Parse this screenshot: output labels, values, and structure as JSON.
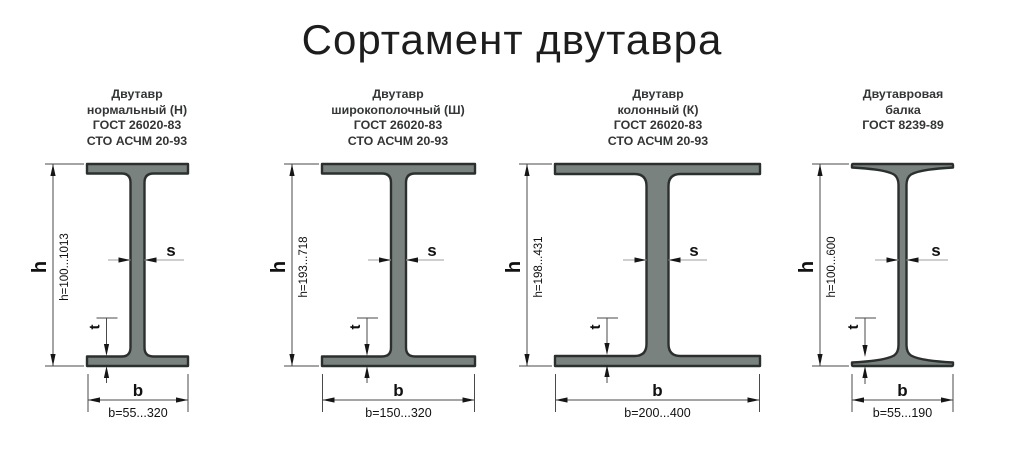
{
  "title": "Сортамент двутавра",
  "labels": {
    "h": "h",
    "s": "s",
    "t": "t",
    "b": "b"
  },
  "beams": [
    {
      "lines": [
        "Двутавр",
        "нормальный (Н)",
        "ГОСТ 26020-83",
        "СТО АСЧМ 20-93"
      ],
      "h_range": "h=100...1013",
      "b_range": "b=55...320"
    },
    {
      "lines": [
        "Двутавр",
        "широкополочный (Ш)",
        "ГОСТ 26020-83",
        "СТО АСЧМ 20-93"
      ],
      "h_range": "h=193...718",
      "b_range": "b=150...320"
    },
    {
      "lines": [
        "Двутавр",
        "колонный (К)",
        "ГОСТ 26020-83",
        "СТО АСЧМ 20-93"
      ],
      "h_range": "h=198...431",
      "b_range": "b=200...400"
    },
    {
      "lines": [
        "Двутавровая",
        "балка",
        "ГОСТ 8239-89"
      ],
      "h_range": "h=100...600",
      "b_range": "b=55...190"
    }
  ],
  "colors": {
    "beam_fill": "#7a8280",
    "beam_outline": "#2b302f",
    "dim_line": "#4a4a4a",
    "light_line": "#b2b2b2",
    "text": "#111111"
  }
}
